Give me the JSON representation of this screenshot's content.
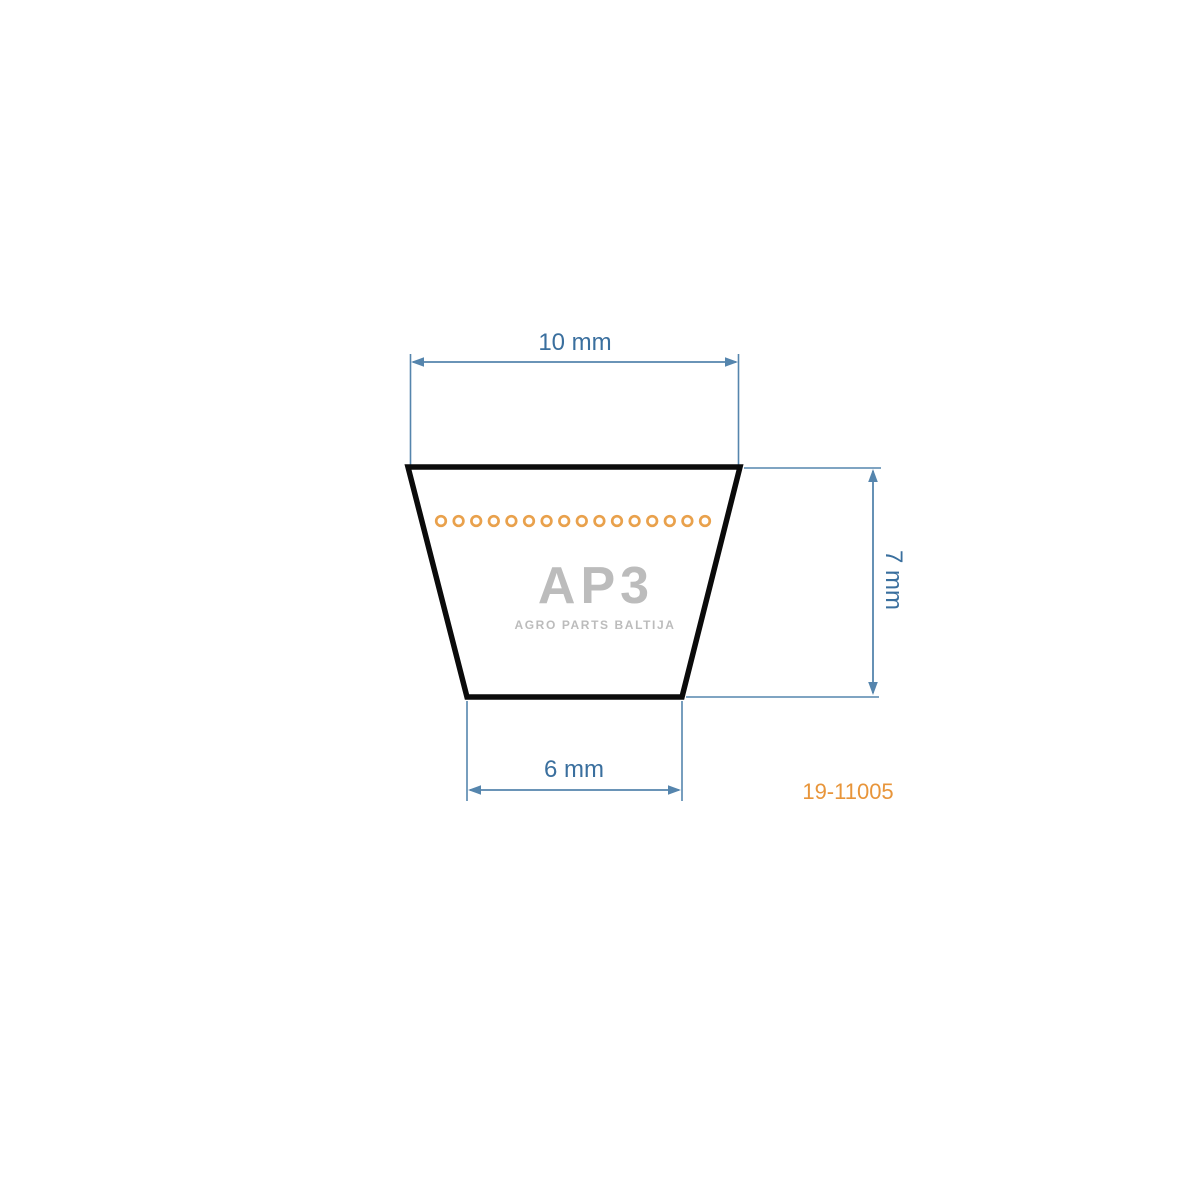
{
  "drawing": {
    "part_number": "19-11005",
    "dimensions": {
      "top_width": "10 mm",
      "height": "7 mm",
      "bottom_width": "6 mm"
    },
    "watermark": {
      "logo": "AP3",
      "tagline": "AGRO PARTS BALTIJA"
    },
    "belt": {
      "cord_circle_count": 16
    },
    "colors": {
      "dimension_line_blue": "#5585ad",
      "dimension_text_blue": "#3a6f9e",
      "outline_black": "#0b0b0b",
      "accent_orange": "#e8953a",
      "cord_orange": "#e9a14c",
      "watermark_gray": "#bcbcbc"
    }
  }
}
